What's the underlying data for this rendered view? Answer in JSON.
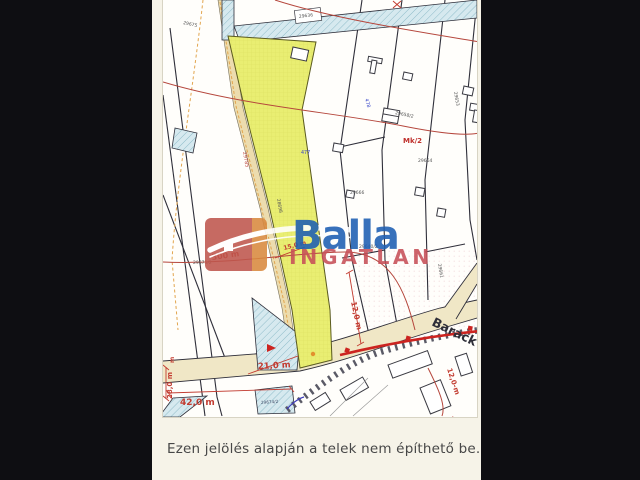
{
  "page": {
    "background": "#f6f3e8",
    "frame_color": "#0e0e12"
  },
  "caption": {
    "text": "Ezen jelölés alapján a telek nem építhető be."
  },
  "logo": {
    "brand": "Balla",
    "subtitle": "INGATLAN",
    "brand_color": "#1d5eb3",
    "subtitle_color": "#c74f58",
    "square_color": "#bf564d",
    "square_accent": "#d9893f"
  },
  "map": {
    "colors": {
      "highlight_parcel": "#e9ee72",
      "water_hatch": "#d6e9ef",
      "road_fill": "#f0e7c6",
      "dimension_red": "#c23b30",
      "contour_red": "#b5463c",
      "utility_red": "#cc2420",
      "parcel_line": "#2f2f3a"
    },
    "labels": [
      {
        "text": "300 m",
        "x": 49,
        "y": 260,
        "rot": -8,
        "size": 8,
        "color": "#c23b30",
        "weight": 700
      },
      {
        "text": "15,0 m",
        "x": 121,
        "y": 250,
        "rot": -14,
        "size": 6,
        "color": "#c23b30",
        "weight": 700
      },
      {
        "text": "21,0 m",
        "x": 95,
        "y": 369,
        "rot": -3,
        "size": 8.5,
        "color": "#c23b30",
        "weight": 700
      },
      {
        "text": "42,0 m",
        "x": 17,
        "y": 405,
        "rot": 0,
        "size": 9,
        "color": "#c23b30",
        "weight": 700
      },
      {
        "text": "28,0 m",
        "x": 9,
        "y": 399,
        "rot": -90,
        "size": 7,
        "color": "#c23b30",
        "weight": 700
      },
      {
        "text": "m",
        "x": 11,
        "y": 363,
        "rot": -90,
        "size": 6,
        "color": "#c23b30",
        "weight": 700
      },
      {
        "text": "12,0 m",
        "x": 188,
        "y": 302,
        "rot": 78,
        "size": 7.5,
        "color": "#c23b30",
        "weight": 700
      },
      {
        "text": "12,0-m",
        "x": 284,
        "y": 369,
        "rot": 72,
        "size": 7,
        "color": "#c23b30",
        "weight": 700
      },
      {
        "text": "Mk/2",
        "x": 240,
        "y": 143,
        "rot": 0,
        "size": 7,
        "color": "#c0302c",
        "weight": 700
      },
      {
        "text": "Lke",
        "x": 284,
        "y": 422,
        "rot": 0,
        "size": 7,
        "color": "#c2544e",
        "weight": 700
      },
      {
        "text": "Barack",
        "x": 268,
        "y": 325,
        "rot": 26,
        "size": 12.5,
        "color": "#2e2e38",
        "weight": 600
      },
      {
        "text": "29785",
        "x": 80,
        "y": 152,
        "rot": 80,
        "size": 5,
        "color": "#bf4a42",
        "weight": 400
      },
      {
        "text": "28698",
        "x": 114,
        "y": 199,
        "rot": 80,
        "size": 4.5,
        "color": "#555555",
        "weight": 400
      },
      {
        "text": "29675",
        "x": 20,
        "y": 24,
        "rot": 12,
        "size": 4.5,
        "color": "#555555",
        "weight": 400
      },
      {
        "text": "29636",
        "x": 136,
        "y": 18,
        "rot": -7,
        "size": 4.5,
        "color": "#555555",
        "weight": 400
      },
      {
        "text": "29653",
        "x": 291,
        "y": 92,
        "rot": 80,
        "size": 4.5,
        "color": "#555555",
        "weight": 400
      },
      {
        "text": "29664",
        "x": 255,
        "y": 162,
        "rot": 0,
        "size": 4.5,
        "color": "#555555",
        "weight": 400
      },
      {
        "text": "29666",
        "x": 187,
        "y": 194,
        "rot": 0,
        "size": 4.5,
        "color": "#555555",
        "weight": 400
      },
      {
        "text": "29658/2",
        "x": 232,
        "y": 114,
        "rot": 12,
        "size": 4.5,
        "color": "#555555",
        "weight": 400
      },
      {
        "text": "29640/2",
        "x": 196,
        "y": 248,
        "rot": 0,
        "size": 4.5,
        "color": "#555555",
        "weight": 400
      },
      {
        "text": "29675/2",
        "x": 30,
        "y": 264,
        "rot": 0,
        "size": 4.5,
        "color": "#555555",
        "weight": 400
      },
      {
        "text": "29674/2",
        "x": 98,
        "y": 404,
        "rot": -4,
        "size": 4.2,
        "color": "#44506b",
        "weight": 400
      },
      {
        "text": "29661",
        "x": 275,
        "y": 264,
        "rot": 80,
        "size": 4.5,
        "color": "#555555",
        "weight": 400
      },
      {
        "text": "477",
        "x": 138,
        "y": 154,
        "rot": 0,
        "size": 4.8,
        "color": "#3b49c9",
        "weight": 400
      },
      {
        "text": "478",
        "x": 202,
        "y": 99,
        "rot": 75,
        "size": 4.8,
        "color": "#3b49c9",
        "weight": 400
      }
    ]
  }
}
